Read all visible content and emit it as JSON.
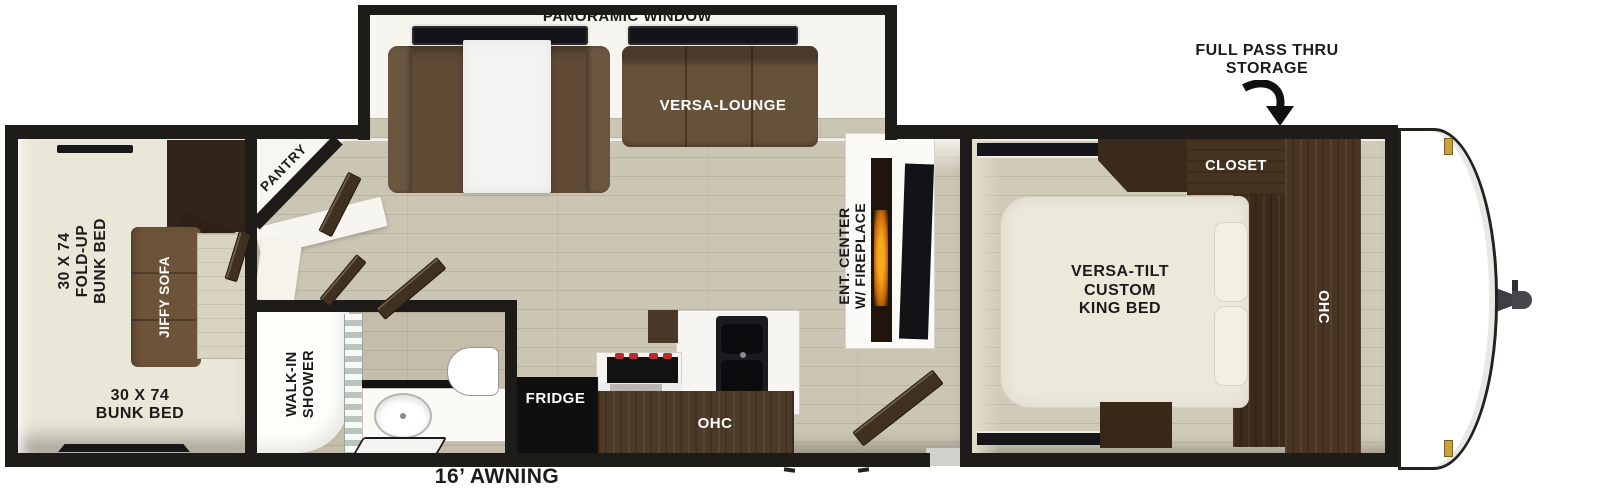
{
  "labels": {
    "panoramic_window": "PANORAMIC WINDOW",
    "versa_lounge": "VERSA-LOUNGE",
    "pantry": "PANTRY",
    "fold_up_bunk_bed": "30 X 74\nFOLD-UP\nBUNK BED",
    "jiffy_sofa": "JIFFY SOFA",
    "bunk_bed": "30 X 74\nBUNK BED",
    "walk_in_shower": "WALK-IN\nSHOWER",
    "fridge": "FRIDGE",
    "kitchen_ohc": "OHC",
    "ent_center": "ENT. CENTER\nW/ FIREPLACE",
    "closet": "CLOSET",
    "king_bed": "VERSA-TILT\nCUSTOM\nKING BED",
    "bedroom_ohc": "OHC",
    "full_pass_thru_storage": "FULL PASS THRU\nSTORAGE",
    "awning": "16’ AWNING"
  },
  "colors": {
    "wall": "#1d1c19",
    "floor_plank": "#cbc5b3",
    "floor_bunk": "#eae6d8",
    "sofa_brown": "#66513a",
    "cabinet_dark_brown": "#46331f",
    "mattress_cream": "#ece9db",
    "appliance_black": "#121214",
    "flame_orange": "#f59b16",
    "marker_gold": "#c9a23c"
  }
}
